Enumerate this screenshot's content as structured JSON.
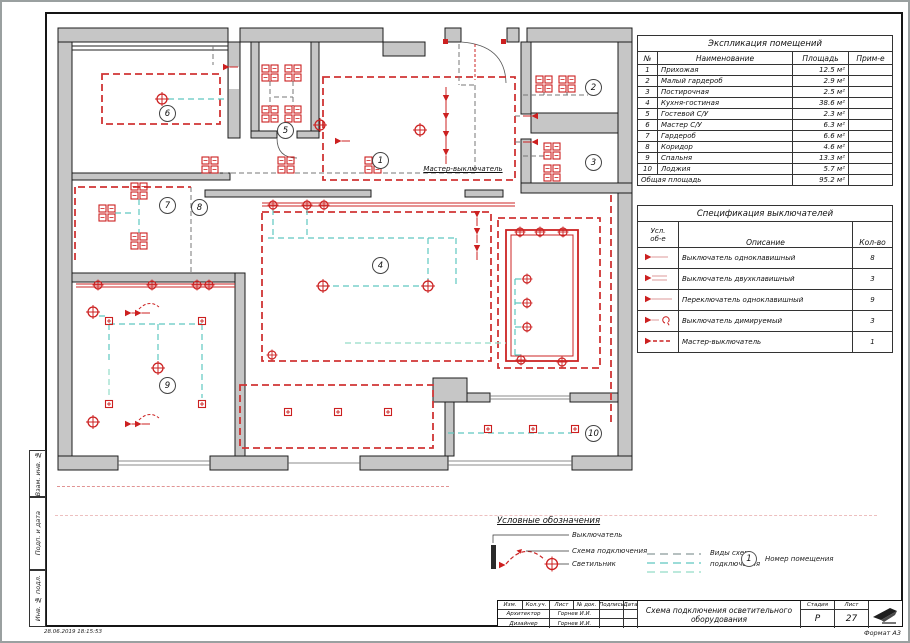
{
  "sheet": {
    "timestamp": "28.06.2019 18:15:53",
    "format_label": "Формат А3",
    "side_labels": {
      "a": "Взам. инв. №",
      "b": "Подп. и дата",
      "c": "Инв. № подл."
    }
  },
  "plan": {
    "master_switch_label": "Мастер-выключатель",
    "room_tags": {
      "r1": "1",
      "r2": "2",
      "r3": "3",
      "r4": "4",
      "r5": "5",
      "r6": "6",
      "r7": "7",
      "r8": "8",
      "r9": "9",
      "r10": "10"
    }
  },
  "explication": {
    "title": "Экспликация помещений",
    "headers": {
      "num": "№",
      "name": "Наименование",
      "area": "Площадь",
      "note": "Прим-е"
    },
    "rows": [
      {
        "num": "1",
        "name": "Прихожая",
        "area": "12.5 м²"
      },
      {
        "num": "2",
        "name": "Малый гардероб",
        "area": "2.9 м²"
      },
      {
        "num": "3",
        "name": "Постирочная",
        "area": "2.5 м²"
      },
      {
        "num": "4",
        "name": "Кухня-гостиная",
        "area": "38.6 м²"
      },
      {
        "num": "5",
        "name": "Гостевой С/У",
        "area": "2.3 м²"
      },
      {
        "num": "6",
        "name": "Мастер С/У",
        "area": "6.3 м²"
      },
      {
        "num": "7",
        "name": "Гардероб",
        "area": "6.6 м²"
      },
      {
        "num": "8",
        "name": "Коридор",
        "area": "4.6 м²"
      },
      {
        "num": "9",
        "name": "Спальня",
        "area": "13.3 м²"
      },
      {
        "num": "10",
        "name": "Лоджия",
        "area": "5.7 м²"
      }
    ],
    "total_label": "Общая площадь",
    "total_value": "95.2 м²"
  },
  "spec": {
    "title": "Спецификация выключателей",
    "headers": {
      "symbol1": "Усл.",
      "symbol2": "об-е",
      "desc": "Описание",
      "qty": "Кол-во"
    },
    "rows": [
      {
        "symbol": "switch-1gang",
        "desc": "Выключатель одноклавишный",
        "qty": "8"
      },
      {
        "symbol": "switch-2gang",
        "desc": "Выключатель двухклавишный",
        "qty": "3"
      },
      {
        "symbol": "toggle-1gang",
        "desc": "Переключатель одноклавишный",
        "qty": "9"
      },
      {
        "symbol": "switch-dimmer",
        "desc": "Выключатель димируемый",
        "qty": "3"
      },
      {
        "symbol": "master-switch",
        "desc": "Мастер-выключатель",
        "qty": "1"
      }
    ]
  },
  "legend": {
    "title": "Условные обозначения",
    "switch_label": "Выключатель",
    "scheme_label": "Схема подключения",
    "light_label": "Светильник",
    "scheme_types_label_1": "Виды схем",
    "scheme_types_label_2": "подключения",
    "room_number_label": "Номер помещения",
    "room_number_example": "1"
  },
  "title_block": {
    "col_headers": [
      "Изм.",
      "Кол.уч.",
      "Лист",
      "№ док.",
      "Подпись",
      "Дата"
    ],
    "row1_role": "Архитектор",
    "row1_name": "Горнев И.И.",
    "row2_role": "Дизайнер",
    "row2_name": "Горнев И.И.",
    "doc_title_1": "Схема подключения осветительного",
    "doc_title_2": "оборудования",
    "stage_label": "Стадия",
    "sheet_label": "Лист",
    "stage_value": "Р",
    "sheet_value": "27"
  },
  "colors": {
    "accent_red": "#cc2020",
    "wall_gray": "#c6c6c6",
    "scheme_teal": "#5fc8c0",
    "scheme_mint": "#93dcc8",
    "scheme_gray": "#8a9a9a"
  }
}
